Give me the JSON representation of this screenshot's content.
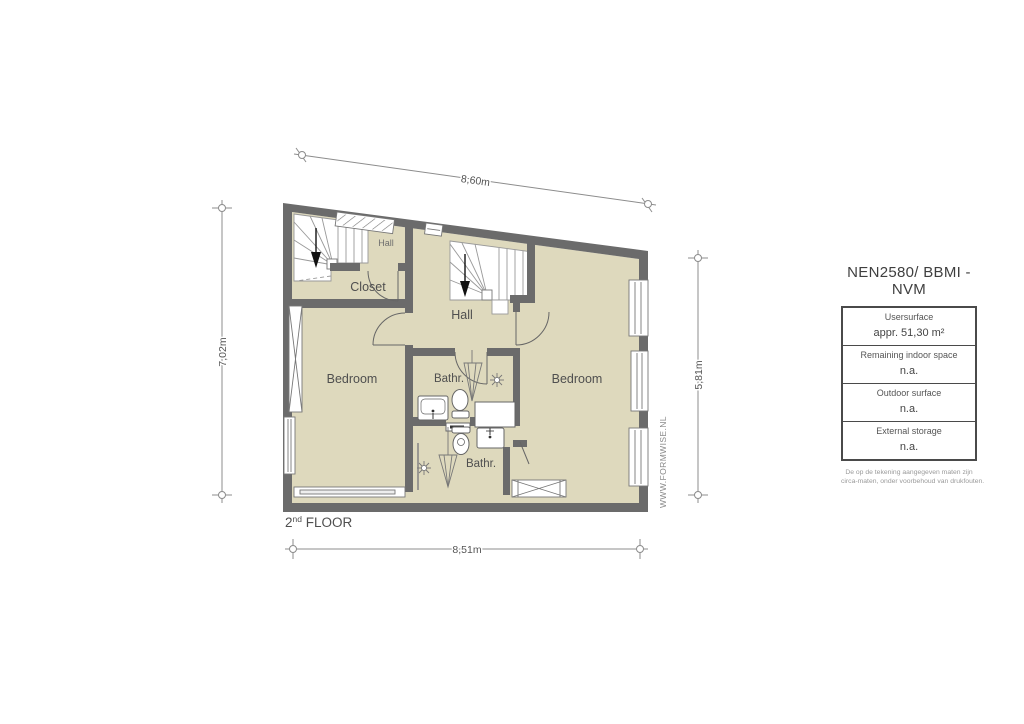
{
  "plan": {
    "floor_label": {
      "num": "2",
      "sup": "nd",
      "rest": " FLOOR"
    },
    "watermark": "WWW.FORMWISE.NL",
    "dims": {
      "top": "8,60m",
      "left": "7,02m",
      "right": "5,81m",
      "bottom": "8,51m"
    },
    "rooms": {
      "hall_small": "Hall",
      "closet": "Closet",
      "hall": "Hall",
      "bedroom_left": "Bedroom",
      "bathroom_top": "Bathr.",
      "bedroom_right": "Bedroom",
      "bathroom_bottom": "Bathr."
    }
  },
  "legend": {
    "title": "NEN2580/ BBMI - NVM",
    "rows": [
      {
        "label": "Usersurface",
        "value": "appr. 51,30 m²"
      },
      {
        "label": "Remaining indoor space",
        "value": "n.a."
      },
      {
        "label": "Outdoor surface",
        "value": "n.a."
      },
      {
        "label": "External storage",
        "value": "n.a."
      }
    ],
    "disclaimer": [
      "De op de tekening aangegeven maten zijn",
      "circa-maten, onder voorbehoud van drukfouten."
    ]
  },
  "colors": {
    "wall": "#6b6b6b",
    "floor": "#ded9bd",
    "stairs": "#ffffff",
    "dimension_line": "#8c8c8c",
    "label_text": "#4f4f4f"
  }
}
